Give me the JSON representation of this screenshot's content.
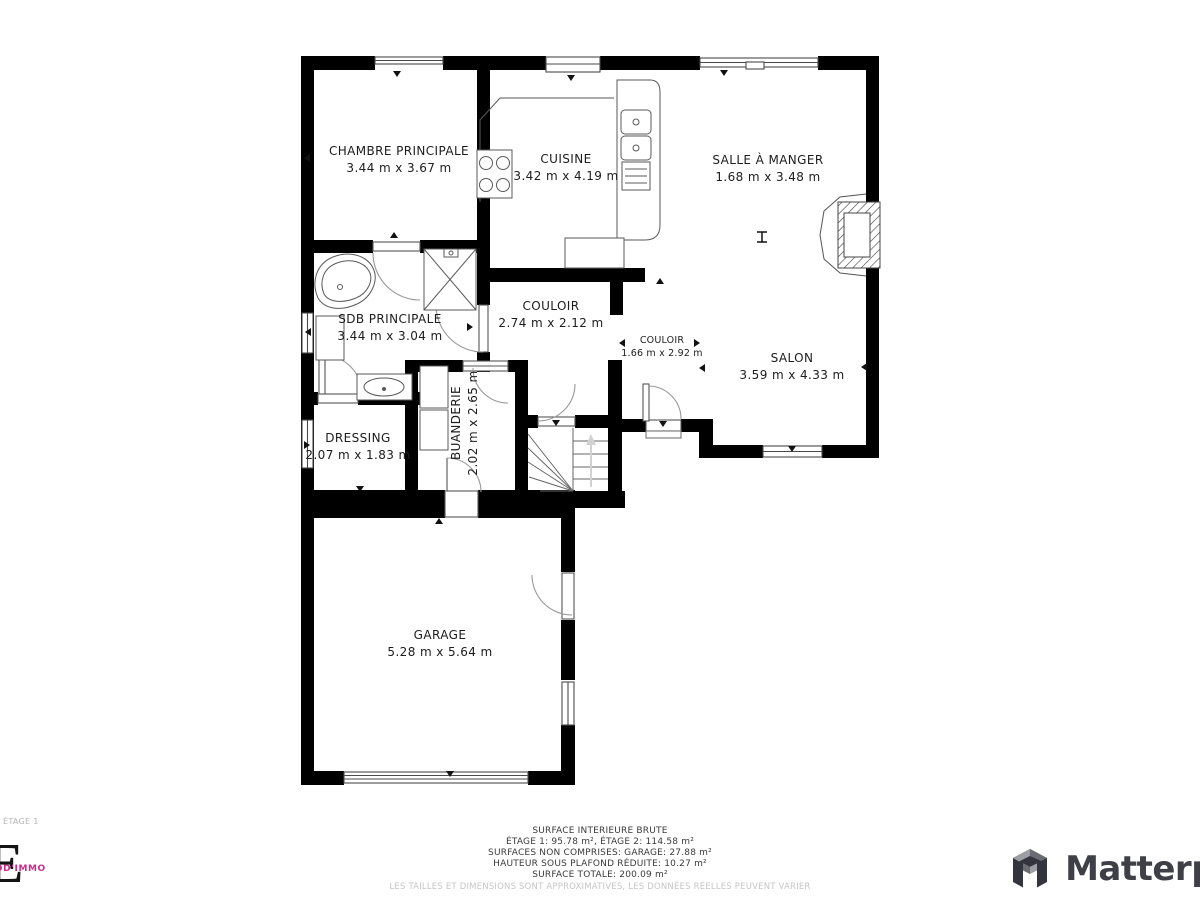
{
  "rooms": [
    {
      "name": "CHAMBRE PRINCIPALE",
      "dims": "3.44 m x 3.67 m"
    },
    {
      "name": "CUISINE",
      "dims": "3.42 m x 4.19 m"
    },
    {
      "name": "SALLE À MANGER",
      "dims": "1.68 m x 3.48 m"
    },
    {
      "name": "SDB PRINCIPALE",
      "dims": "3.44 m x 3.04 m"
    },
    {
      "name": "COULOIR",
      "dims": "2.74 m x 2.12 m"
    },
    {
      "name": "COULOIR",
      "dims": "1.66 m x 2.92 m"
    },
    {
      "name": "SALON",
      "dims": "3.59 m x 4.33 m"
    },
    {
      "name": "DRESSING",
      "dims": "2.07 m x 1.83 m"
    },
    {
      "name": "BUANDERIE",
      "dims": "2.02 m x 2.65 m"
    },
    {
      "name": "GARAGE",
      "dims": "5.28 m x 5.64 m"
    }
  ],
  "floor_label": "ÉTAGE 1",
  "summary": {
    "line1": "SURFACE INTERIEURE BRUTE",
    "line2": "ÉTAGE 1: 95.78 m², ÉTAGE 2: 114.58 m²",
    "line3": "SURFACES NON COMPRISES: GARAGE: 27.88 m²",
    "line4": "HAUTEUR SOUS PLAFOND RÉDUITE: 10.27 m²",
    "line5": "SURFACE TOTALE: 200.09 m²",
    "disclaimer": "LES TAILLES ET DIMENSIONS SONT APPROXIMATIVES, LES DONNÉES RÉELLES PEUVENT VARIER"
  },
  "branding": {
    "agency_letter": "E",
    "agency_text": "DD'IMMO",
    "agency_color": "#cc2b8e",
    "matterport_text": "Matterport"
  }
}
